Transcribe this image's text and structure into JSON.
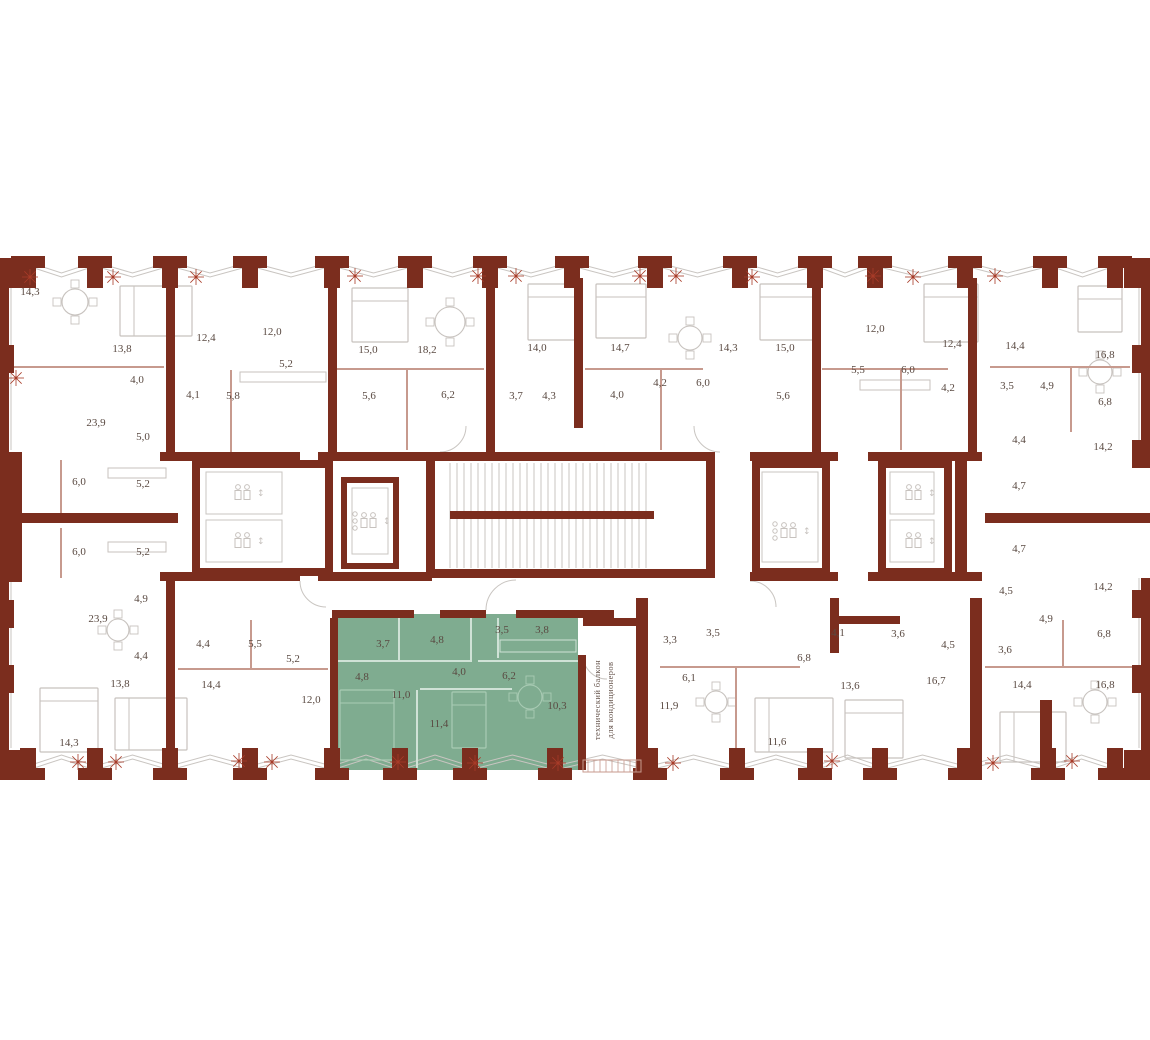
{
  "meta": {
    "drawing_type": "residential-floor-plan",
    "highlighted_apartment_room_count": 10
  },
  "colors": {
    "wall": "#7b2d1e",
    "wall_dark": "#6e2719",
    "partition": "#c79a8e",
    "line": "#c9c5c1",
    "furniture": "#c7c2be",
    "green_fill": "#7fac90",
    "green_line": "#cfe2d6",
    "green_soft": "#a9cbb4",
    "star": "#a83b28",
    "label": "#5a4a42",
    "balcony_text": "#6b5a52"
  },
  "canvas": {
    "w": 1150,
    "h": 1040
  },
  "highlighted_apartment": {
    "polygon": {
      "x": 336,
      "y": 614,
      "w": 242,
      "h": 156
    },
    "room_areas": [
      "3,7",
      "4,8",
      "3,5",
      "3,8",
      "4,8",
      "4,0",
      "6,2",
      "11,0",
      "11,4",
      "10,3"
    ],
    "balcony_lines": [
      "технический балкон",
      "для кондиционеров"
    ],
    "balcony_pos": {
      "x1": 600,
      "x2": 613,
      "y": 700
    }
  },
  "labels": [
    {
      "t": "14,3",
      "x": 30,
      "y": 295
    },
    {
      "t": "13,8",
      "x": 122,
      "y": 352
    },
    {
      "t": "4,0",
      "x": 137,
      "y": 383
    },
    {
      "t": "12,4",
      "x": 206,
      "y": 341
    },
    {
      "t": "12,0",
      "x": 272,
      "y": 335
    },
    {
      "t": "5,2",
      "x": 286,
      "y": 367
    },
    {
      "t": "4,1",
      "x": 193,
      "y": 398
    },
    {
      "t": "5,8",
      "x": 233,
      "y": 399
    },
    {
      "t": "23,9",
      "x": 96,
      "y": 426
    },
    {
      "t": "5,0",
      "x": 143,
      "y": 440
    },
    {
      "t": "15,0",
      "x": 368,
      "y": 353
    },
    {
      "t": "18,2",
      "x": 427,
      "y": 353
    },
    {
      "t": "5,6",
      "x": 369,
      "y": 399
    },
    {
      "t": "6,2",
      "x": 448,
      "y": 398
    },
    {
      "t": "3,7",
      "x": 516,
      "y": 399
    },
    {
      "t": "14,0",
      "x": 537,
      "y": 351
    },
    {
      "t": "4,3",
      "x": 549,
      "y": 399
    },
    {
      "t": "14,7",
      "x": 620,
      "y": 351
    },
    {
      "t": "4,0",
      "x": 617,
      "y": 398
    },
    {
      "t": "4,2",
      "x": 660,
      "y": 386
    },
    {
      "t": "6,0",
      "x": 703,
      "y": 386
    },
    {
      "t": "14,3",
      "x": 728,
      "y": 351
    },
    {
      "t": "15,0",
      "x": 785,
      "y": 351
    },
    {
      "t": "5,6",
      "x": 783,
      "y": 399
    },
    {
      "t": "12,0",
      "x": 875,
      "y": 332
    },
    {
      "t": "5,5",
      "x": 858,
      "y": 373
    },
    {
      "t": "6,0",
      "x": 908,
      "y": 373
    },
    {
      "t": "12,4",
      "x": 952,
      "y": 347
    },
    {
      "t": "4,2",
      "x": 948,
      "y": 391
    },
    {
      "t": "14,4",
      "x": 1015,
      "y": 349
    },
    {
      "t": "3,5",
      "x": 1007,
      "y": 389
    },
    {
      "t": "4,9",
      "x": 1047,
      "y": 389
    },
    {
      "t": "16,8",
      "x": 1105,
      "y": 358
    },
    {
      "t": "6,8",
      "x": 1105,
      "y": 405
    },
    {
      "t": "4,4",
      "x": 1019,
      "y": 443
    },
    {
      "t": "14,2",
      "x": 1103,
      "y": 450
    },
    {
      "t": "6,0",
      "x": 79,
      "y": 485
    },
    {
      "t": "5,2",
      "x": 143,
      "y": 487
    },
    {
      "t": "6,0",
      "x": 79,
      "y": 555
    },
    {
      "t": "5,2",
      "x": 143,
      "y": 555
    },
    {
      "t": "4,9",
      "x": 141,
      "y": 602
    },
    {
      "t": "4,7",
      "x": 1019,
      "y": 489
    },
    {
      "t": "4,7",
      "x": 1019,
      "y": 552
    },
    {
      "t": "4,5",
      "x": 1006,
      "y": 594
    },
    {
      "t": "14,2",
      "x": 1103,
      "y": 590
    },
    {
      "t": "23,9",
      "x": 98,
      "y": 622
    },
    {
      "t": "4,4",
      "x": 141,
      "y": 659
    },
    {
      "t": "4,4",
      "x": 203,
      "y": 647
    },
    {
      "t": "5,5",
      "x": 255,
      "y": 647
    },
    {
      "t": "5,2",
      "x": 293,
      "y": 662
    },
    {
      "t": "13,8",
      "x": 120,
      "y": 687
    },
    {
      "t": "14,4",
      "x": 211,
      "y": 688
    },
    {
      "t": "12,0",
      "x": 311,
      "y": 703
    },
    {
      "t": "14,3",
      "x": 69,
      "y": 746
    },
    {
      "t": "3,7",
      "x": 383,
      "y": 647,
      "g": 1
    },
    {
      "t": "4,8",
      "x": 437,
      "y": 643,
      "g": 1
    },
    {
      "t": "3,5",
      "x": 502,
      "y": 633,
      "g": 1
    },
    {
      "t": "3,8",
      "x": 542,
      "y": 633,
      "g": 1
    },
    {
      "t": "4,8",
      "x": 362,
      "y": 680,
      "g": 1
    },
    {
      "t": "4,0",
      "x": 459,
      "y": 675,
      "g": 1
    },
    {
      "t": "6,2",
      "x": 509,
      "y": 679,
      "g": 1
    },
    {
      "t": "11,0",
      "x": 401,
      "y": 698,
      "g": 1
    },
    {
      "t": "11,4",
      "x": 439,
      "y": 727,
      "g": 1
    },
    {
      "t": "10,3",
      "x": 557,
      "y": 709,
      "g": 1
    },
    {
      "t": "3,3",
      "x": 670,
      "y": 643
    },
    {
      "t": "3,5",
      "x": 713,
      "y": 636
    },
    {
      "t": "6,1",
      "x": 689,
      "y": 681
    },
    {
      "t": "11,9",
      "x": 669,
      "y": 709
    },
    {
      "t": "6,8",
      "x": 804,
      "y": 661
    },
    {
      "t": "4,1",
      "x": 838,
      "y": 636
    },
    {
      "t": "11,6",
      "x": 777,
      "y": 745
    },
    {
      "t": "13,6",
      "x": 850,
      "y": 689
    },
    {
      "t": "3,6",
      "x": 898,
      "y": 637
    },
    {
      "t": "16,7",
      "x": 936,
      "y": 684
    },
    {
      "t": "4,5",
      "x": 948,
      "y": 648
    },
    {
      "t": "4,9",
      "x": 1046,
      "y": 622
    },
    {
      "t": "6,8",
      "x": 1104,
      "y": 637
    },
    {
      "t": "3,6",
      "x": 1005,
      "y": 653
    },
    {
      "t": "14,4",
      "x": 1022,
      "y": 688
    },
    {
      "t": "16,8",
      "x": 1105,
      "y": 688
    }
  ],
  "walls": [
    [
      160,
      452,
      140,
      9
    ],
    [
      318,
      452,
      114,
      9
    ],
    [
      750,
      452,
      88,
      9
    ],
    [
      868,
      452,
      114,
      9
    ],
    [
      160,
      572,
      140,
      9
    ],
    [
      318,
      572,
      114,
      9
    ],
    [
      750,
      572,
      88,
      9
    ],
    [
      868,
      572,
      114,
      9
    ],
    [
      0,
      513,
      178,
      10
    ],
    [
      985,
      513,
      165,
      10
    ],
    [
      332,
      610,
      82,
      8
    ],
    [
      440,
      610,
      46,
      8
    ],
    [
      516,
      610,
      98,
      8
    ],
    [
      830,
      616,
      70,
      8
    ],
    [
      0,
      270,
      9,
      185
    ],
    [
      0,
      452,
      22,
      130
    ],
    [
      0,
      578,
      9,
      185
    ],
    [
      1141,
      270,
      9,
      185
    ],
    [
      1141,
      578,
      9,
      185
    ],
    [
      166,
      278,
      9,
      178
    ],
    [
      328,
      278,
      9,
      178
    ],
    [
      486,
      278,
      9,
      178
    ],
    [
      574,
      278,
      9,
      150
    ],
    [
      812,
      278,
      9,
      178
    ],
    [
      968,
      278,
      9,
      178
    ],
    [
      166,
      578,
      9,
      190
    ],
    [
      330,
      618,
      8,
      152
    ],
    [
      636,
      598,
      12,
      172
    ],
    [
      970,
      598,
      12,
      172
    ],
    [
      1040,
      700,
      12,
      70
    ],
    [
      830,
      598,
      9,
      55
    ],
    [
      578,
      655,
      8,
      115
    ],
    [
      640,
      622,
      8,
      148
    ],
    [
      583,
      618,
      60,
      8
    ],
    [
      426,
      452,
      9,
      126
    ],
    [
      706,
      452,
      9,
      126
    ],
    [
      426,
      452,
      289,
      9
    ],
    [
      426,
      569,
      289,
      9
    ],
    [
      450,
      511,
      204,
      8
    ],
    [
      192,
      460,
      141,
      8
    ],
    [
      192,
      568,
      141,
      8
    ],
    [
      192,
      460,
      8,
      116
    ],
    [
      325,
      460,
      8,
      116
    ],
    [
      341,
      477,
      6,
      92
    ],
    [
      393,
      477,
      6,
      92
    ],
    [
      341,
      477,
      58,
      6
    ],
    [
      341,
      563,
      58,
      6
    ],
    [
      752,
      460,
      78,
      8
    ],
    [
      752,
      568,
      78,
      8
    ],
    [
      752,
      460,
      8,
      116
    ],
    [
      822,
      460,
      8,
      116
    ],
    [
      878,
      460,
      74,
      8
    ],
    [
      878,
      568,
      74,
      8
    ],
    [
      878,
      460,
      8,
      116
    ],
    [
      944,
      460,
      8,
      116
    ],
    [
      955,
      460,
      12,
      116
    ],
    [
      1124,
      258,
      26,
      30
    ],
    [
      0,
      258,
      26,
      30
    ],
    [
      0,
      750,
      26,
      30
    ],
    [
      1124,
      750,
      26,
      30
    ]
  ],
  "partitions": [
    [
      12,
      366,
      152,
      2
    ],
    [
      230,
      370,
      2,
      82
    ],
    [
      336,
      368,
      148,
      2
    ],
    [
      406,
      370,
      2,
      80
    ],
    [
      585,
      368,
      118,
      2
    ],
    [
      660,
      370,
      2,
      80
    ],
    [
      822,
      368,
      126,
      2
    ],
    [
      900,
      370,
      2,
      80
    ],
    [
      990,
      366,
      140,
      2
    ],
    [
      1070,
      368,
      2,
      64
    ],
    [
      178,
      668,
      150,
      2
    ],
    [
      250,
      620,
      2,
      48
    ],
    [
      660,
      666,
      140,
      2
    ],
    [
      735,
      668,
      2,
      100
    ],
    [
      985,
      666,
      160,
      2
    ],
    [
      1062,
      620,
      2,
      46
    ],
    [
      60,
      460,
      2,
      54
    ],
    [
      60,
      528,
      2,
      50
    ]
  ],
  "green_partitions": [
    [
      398,
      618,
      2,
      42
    ],
    [
      338,
      660,
      134,
      2
    ],
    [
      470,
      618,
      2,
      42
    ],
    [
      478,
      660,
      100,
      2
    ],
    [
      416,
      690,
      2,
      78
    ],
    [
      420,
      688,
      92,
      2
    ],
    [
      497,
      618,
      2,
      40
    ]
  ],
  "piers_top": [
    28,
    95,
    170,
    250,
    332,
    415,
    490,
    572,
    655,
    740,
    815,
    875,
    965,
    1050,
    1115
  ],
  "piers_bottom": [
    28,
    95,
    170,
    250,
    332,
    400,
    470,
    555,
    650,
    737,
    815,
    880,
    965,
    1048,
    1115
  ],
  "side_blocks_left": [
    345,
    600,
    665
  ],
  "side_blocks_right": [
    345,
    440,
    590,
    665
  ],
  "stairs": {
    "x0": 450,
    "x1": 652,
    "y0": 463,
    "y1": 568,
    "step": 7
  },
  "elevators": [
    {
      "cx": 244,
      "cy": 493
    },
    {
      "cx": 244,
      "cy": 541
    },
    {
      "cx": 915,
      "cy": 493
    },
    {
      "cx": 915,
      "cy": 541
    }
  ],
  "freight_elevators": [
    {
      "cx": 370,
      "cy": 521
    },
    {
      "cx": 790,
      "cy": 531
    }
  ],
  "cabins": [
    [
      206,
      472,
      76,
      42
    ],
    [
      206,
      520,
      76,
      42
    ],
    [
      352,
      488,
      36,
      66
    ],
    [
      762,
      472,
      56,
      90
    ],
    [
      890,
      472,
      44,
      42
    ],
    [
      890,
      520,
      44,
      42
    ]
  ],
  "beds": [
    [
      120,
      286,
      72,
      50,
      "h"
    ],
    [
      352,
      288,
      56,
      54,
      "v"
    ],
    [
      528,
      284,
      54,
      56,
      "v"
    ],
    [
      596,
      284,
      50,
      54,
      "v"
    ],
    [
      760,
      284,
      54,
      56,
      "v"
    ],
    [
      924,
      284,
      54,
      58,
      "v"
    ],
    [
      1078,
      286,
      44,
      46,
      "v"
    ],
    [
      40,
      688,
      58,
      64,
      "v"
    ],
    [
      115,
      698,
      72,
      52,
      "h"
    ],
    [
      755,
      698,
      78,
      54,
      "h"
    ],
    [
      845,
      700,
      58,
      58,
      "v"
    ],
    [
      1000,
      712,
      66,
      50,
      "h"
    ]
  ],
  "green_beds": [
    [
      340,
      690,
      54,
      70,
      "v"
    ],
    [
      452,
      692,
      34,
      56,
      "v"
    ]
  ],
  "tables": [
    [
      75,
      302,
      13
    ],
    [
      450,
      322,
      15
    ],
    [
      690,
      338,
      12
    ],
    [
      1100,
      372,
      12
    ],
    [
      716,
      702,
      11
    ],
    [
      1095,
      702,
      12
    ],
    [
      118,
      630,
      11
    ]
  ],
  "green_tables": [
    [
      530,
      697,
      12
    ]
  ],
  "counters": [
    [
      108,
      468,
      58,
      10
    ],
    [
      108,
      542,
      58,
      10
    ],
    [
      240,
      372,
      86,
      10
    ],
    [
      860,
      380,
      70,
      10
    ]
  ],
  "green_counters": [
    [
      500,
      640,
      76,
      12
    ]
  ],
  "door_arcs": [
    "M486,610 A30,30 0 0 1 516,580",
    "M583,655 A24,24 0 0 0 607,679",
    "M300,581 A26,26 0 0 0 326,607",
    "M750,581 A26,26 0 0 1 776,607",
    "M440,452 A26,26 0 0 0 466,426",
    "M720,452 A26,26 0 0 1 694,426"
  ],
  "stars_top": [
    [
      30,
      277
    ],
    [
      113,
      277
    ],
    [
      196,
      277
    ],
    [
      355,
      276
    ],
    [
      478,
      276
    ],
    [
      516,
      276
    ],
    [
      640,
      276
    ],
    [
      676,
      276
    ],
    [
      752,
      277
    ],
    [
      873,
      276
    ],
    [
      913,
      277
    ],
    [
      995,
      276
    ]
  ],
  "stars_bottom": [
    [
      78,
      762
    ],
    [
      116,
      762
    ],
    [
      239,
      761
    ],
    [
      272,
      762
    ],
    [
      398,
      762
    ],
    [
      475,
      763
    ],
    [
      558,
      763
    ],
    [
      673,
      763
    ],
    [
      832,
      761
    ],
    [
      993,
      763
    ],
    [
      1072,
      761
    ]
  ],
  "stars_side": [
    [
      16,
      378
    ]
  ],
  "facade": {
    "top_y": 262,
    "top_dip": 273,
    "bottom_y": 770,
    "bottom_rise": 759
  },
  "balcony_sill": {
    "x": 583,
    "y": 760,
    "w": 58,
    "h": 12
  }
}
